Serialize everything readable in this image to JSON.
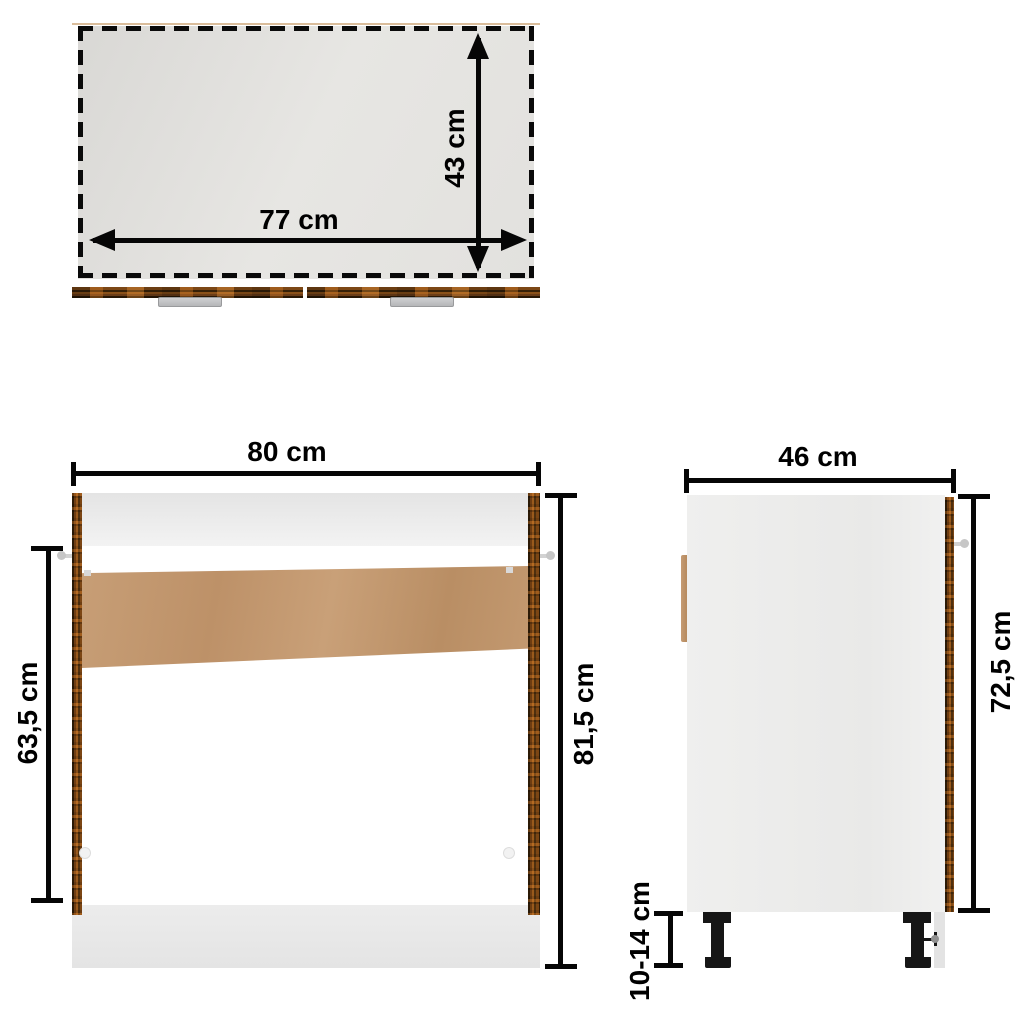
{
  "diagram_title": "Sink base cabinet dimension diagram",
  "views": {
    "top": {
      "name": "top-view",
      "width_label": "77 cm",
      "depth_label": "43 cm"
    },
    "front": {
      "name": "front-view",
      "width_label": "80 cm",
      "total_height_label": "81,5 cm",
      "opening_height_label": "63,5 cm"
    },
    "side": {
      "name": "side-view",
      "depth_label": "46 cm",
      "body_height_label": "72,5 cm",
      "leg_height_label": "10-14 cm"
    }
  },
  "colors": {
    "background": "#ffffff",
    "dimension_lines": "#060606",
    "wood_dark": "#50300e",
    "wood_light": "#9a5a1c",
    "back_panel_mdf": "#c49a72",
    "panel_gray": "#ececec",
    "legs_black": "#161616"
  }
}
